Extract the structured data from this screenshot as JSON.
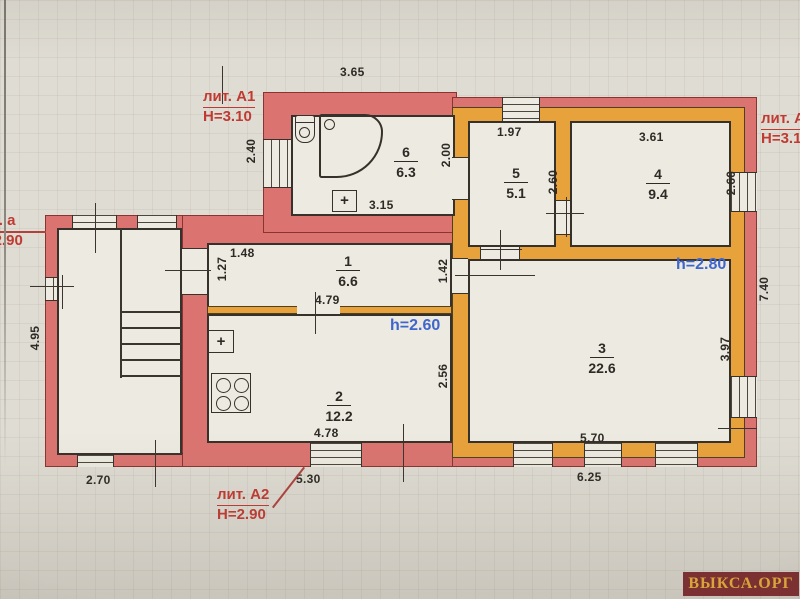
{
  "plan": {
    "literas": {
      "a1": {
        "name": "лит. А1",
        "height": "Н=3.10"
      },
      "a_porch": {
        "name": "лит. а",
        "height": "Н=2.90"
      },
      "a2": {
        "name": "лит. А2",
        "height": "Н=2.90"
      },
      "a_main": {
        "name": "лит. А",
        "height": "Н=3.10"
      }
    },
    "ceiling_heights": {
      "room3": "h=2.80",
      "room2": "h=2.60"
    },
    "rooms": {
      "r1": {
        "number": "1",
        "area": "6.6"
      },
      "r2": {
        "number": "2",
        "area": "12.2"
      },
      "r3": {
        "number": "3",
        "area": "22.6"
      },
      "r4": {
        "number": "4",
        "area": "9.4"
      },
      "r5": {
        "number": "5",
        "area": "5.1"
      },
      "r6": {
        "number": "6",
        "area": "6.3"
      }
    },
    "dims": {
      "a1_top": "3.65",
      "a1_left": "2.40",
      "door_200": "2.00",
      "r5_w": "1.97",
      "r4_w": "3.61",
      "r5_h": "2.60",
      "r4_h": "2.60",
      "r6_w": "3.15",
      "r1_seg_w": "1.48",
      "r1_seg_h": "1.27",
      "r1_w": "4.79",
      "door_142": "1.42",
      "r2_w": "4.78",
      "r2_h": "2.56",
      "r3_w": "5.70",
      "r3_h": "3.97",
      "main_right": "7.40",
      "porch_left": "4.95",
      "porch_bottom": "2.70",
      "a2_bottom": "5.30",
      "main_bottom": "6.25"
    },
    "symbols": {
      "stove_plus": "+"
    }
  },
  "watermark": {
    "text": "ВЫКСА.ОРГ"
  },
  "colors": {
    "wall_red": "#db7470",
    "wall_orange": "#e8a23c",
    "annotation_red": "#c13a32",
    "height_blue": "#3e66cc",
    "watermark_bg": "#7b3131",
    "watermark_text": "#d9a43c"
  }
}
